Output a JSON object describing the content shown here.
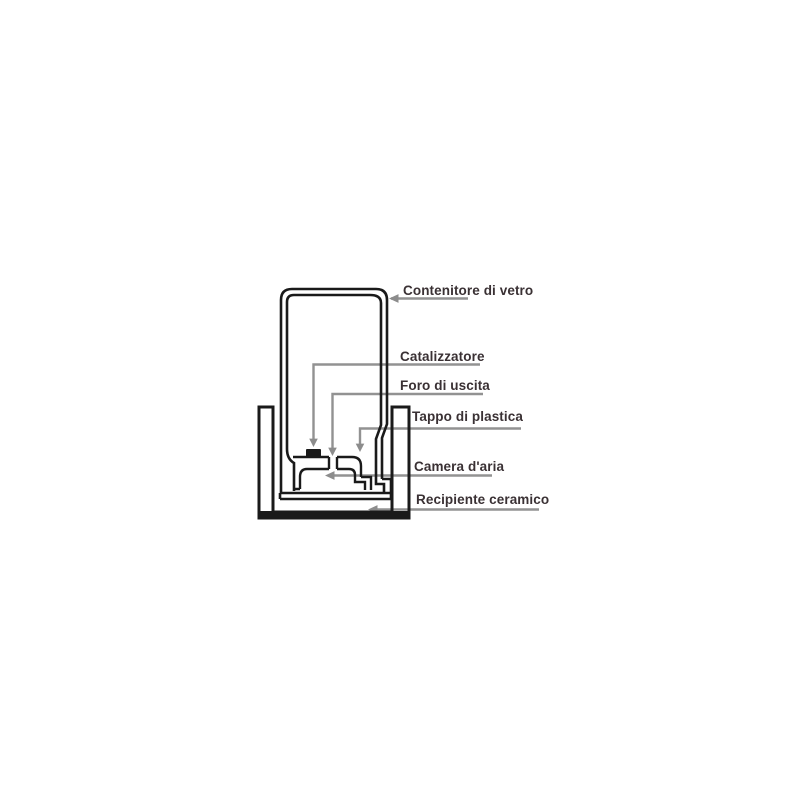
{
  "diagram": {
    "description": "Cross-section diagram of a catalytic burner bottle inside a ceramic vessel",
    "colors": {
      "background": "#ffffff",
      "ink": "#1a1a1a",
      "leader_line": "#929292",
      "label_text": "#3a3134"
    },
    "labels": [
      {
        "id": "contenitore-di-vetro",
        "text": "Contenitore di vetro"
      },
      {
        "id": "catalizzatore",
        "text": "Catalizzatore"
      },
      {
        "id": "foro-di-uscita",
        "text": "Foro di uscita"
      },
      {
        "id": "tappo-di-plastica",
        "text": "Tappo di plastica"
      },
      {
        "id": "camera-daria",
        "text": "Camera d'aria"
      },
      {
        "id": "recipiente-ceramico",
        "text": "Recipiente ceramico"
      }
    ]
  }
}
